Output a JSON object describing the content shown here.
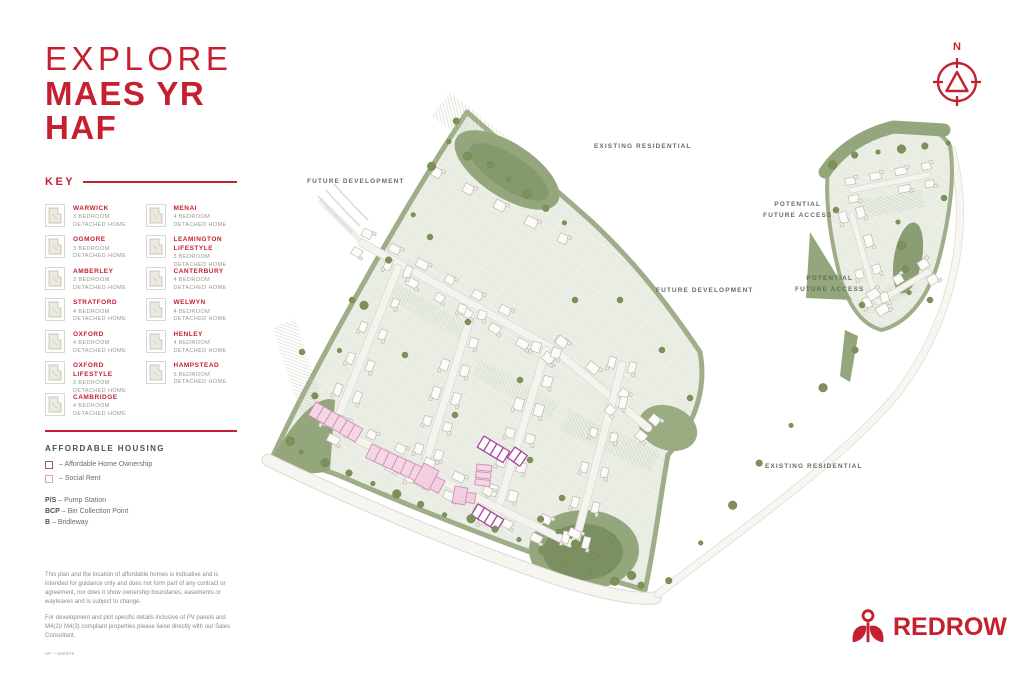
{
  "header": {
    "line1": "EXPLORE",
    "line2": "MAES YR",
    "line3": "HAF"
  },
  "key": {
    "heading": "KEY",
    "columns": [
      [
        {
          "name": "WARWICK",
          "beds": "3 BEDROOM",
          "type": "DETACHED HOME"
        },
        {
          "name": "OGMORE",
          "beds": "3 BEDROOM",
          "type": "DETACHED HOME"
        },
        {
          "name": "AMBERLEY",
          "beds": "3 BEDROOM",
          "type": "DETACHED HOME"
        },
        {
          "name": "STRATFORD",
          "beds": "4 BEDROOM",
          "type": "DETACHED HOME"
        },
        {
          "name": "OXFORD",
          "beds": "4 BEDROOM",
          "type": "DETACHED HOME"
        },
        {
          "name": "OXFORD LIFESTYLE",
          "beds": "3 BEDROOM",
          "type": "DETACHED HOME"
        },
        {
          "name": "CAMBRIDGE",
          "beds": "4 BEDROOM",
          "type": "DETACHED HOME"
        }
      ],
      [
        {
          "name": "MENAI",
          "beds": "4 BEDROOM",
          "type": "DETACHED HOME"
        },
        {
          "name": "LEAMINGTON LIFESTYLE",
          "beds": "3 BEDROOM",
          "type": "DETACHED HOME"
        },
        {
          "name": "CANTERBURY",
          "beds": "4 BEDROOM",
          "type": "DETACHED HOME"
        },
        {
          "name": "WELWYN",
          "beds": "4 BEDROOM",
          "type": "DETACHED HOME"
        },
        {
          "name": "HENLEY",
          "beds": "4 BEDROOM",
          "type": "DETACHED HOME"
        },
        {
          "name": "HAMPSTEAD",
          "beds": "5 BEDROOM",
          "type": "DETACHED HOME"
        }
      ]
    ]
  },
  "affordable": {
    "heading": "AFFORDABLE HOUSING",
    "legend": [
      {
        "label": "– Affordable Home Ownership",
        "box_color": "#a8489b"
      },
      {
        "label": "– Social Rent",
        "box_color": "#dca6c8"
      }
    ],
    "abbreviations": [
      {
        "abbr": "P/S",
        "label": " – Pump Station"
      },
      {
        "abbr": "BCP",
        "label": " – Bin Collection Point"
      },
      {
        "abbr": "B",
        "label": " – Bridleway"
      }
    ]
  },
  "disclaimer": {
    "para1": "This plan and the location of affordable homes is indicative and is intended for guidance only and does not form part of any contract or agreement, nor does it show ownership boundaries, easements or wayleaves and is subject to change.",
    "para2": "For development and plot specific details inclusive of PV panels and M4(2)/ M4(3) compliant properties please liaise directly with our Sales Consultant.",
    "ref": "AP – 650876"
  },
  "map": {
    "labels": [
      {
        "lines": [
          "FUTURE DEVELOPMENT"
        ],
        "x": 307,
        "y": 176
      },
      {
        "lines": [
          "EXISTING RESIDENTIAL"
        ],
        "x": 594,
        "y": 141
      },
      {
        "lines": [
          "FUTURE DEVELOPMENT"
        ],
        "x": 656,
        "y": 285
      },
      {
        "lines": [
          "POTENTIAL",
          "FUTURE ACCESS"
        ],
        "x": 763,
        "y": 199
      },
      {
        "lines": [
          "POTENTIAL",
          "FUTURE ACCESS"
        ],
        "x": 795,
        "y": 273
      },
      {
        "lines": [
          "EXISTING RESIDENTIAL"
        ],
        "x": 765,
        "y": 461
      }
    ]
  },
  "compass": {
    "north": "N"
  },
  "brand": {
    "name": "REDROW"
  },
  "colors": {
    "brand_red": "#c5202f",
    "sage_green": "#93a67c",
    "dark_green": "#7d9158",
    "affordable_ownership": "#a8489b",
    "social_rent_stroke": "#cf8fb5",
    "social_rent_fill": "#f5d6e4"
  }
}
